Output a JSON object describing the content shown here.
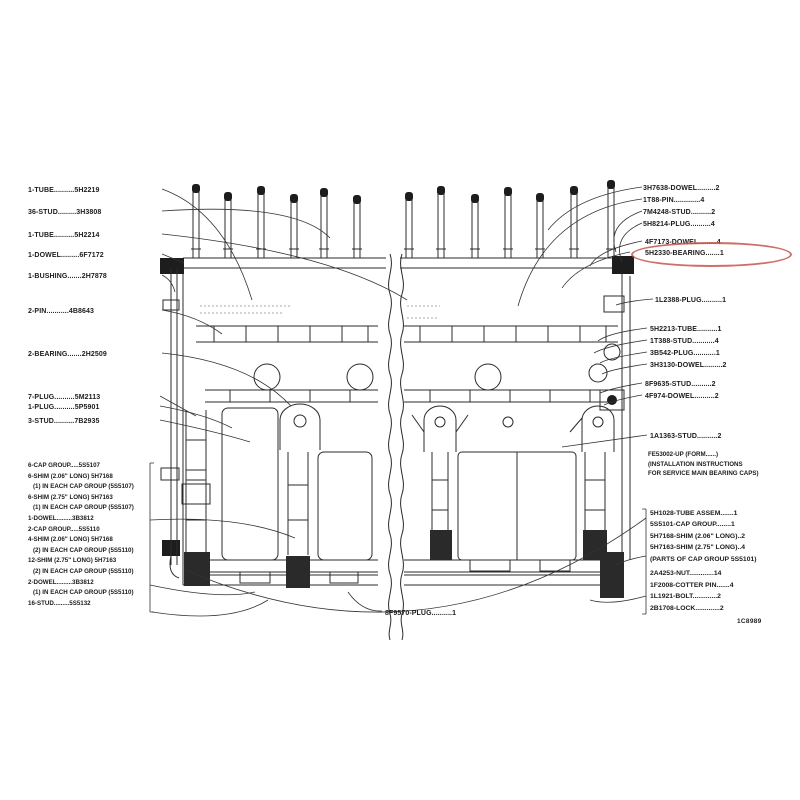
{
  "figure": {
    "number": "1C8989",
    "highlighted_part": "5H2330-BEARING",
    "highlight_color": "#c4564a"
  },
  "labels": {
    "left_column": [
      "1-TUBE..........5H2219",
      "36-STUD.........3H3808",
      "1-TUBE..........5H2214",
      "1-DOWEL.........6F7172",
      "1-BUSHING.......2H7878",
      "2-PIN...........4B8643",
      "2-BEARING.......2H2509",
      "7-PLUG..........5M2113",
      "1-PLUG..........5P5901",
      "3-STUD..........7B2935"
    ],
    "left_cap_block": [
      "6-CAP GROUP.....5S5107",
      "6-SHIM (2.06\" LONG) 5H7168",
      "(1) IN EACH CAP GROUP (5S5107)",
      "6-SHIM (2.75\" LONG) 5H7163",
      "(1) IN EACH CAP GROUP (5S5107)",
      "1-DOWEL.........3B3812",
      "2-CAP GROUP.....5S5110",
      "4-SHIM (2.06\" LONG) 5H7168",
      "(2) IN EACH CAP GROUP (5S5110)",
      "12-SHIM (2.75\" LONG) 5H7163",
      "(2) IN EACH CAP GROUP (5S5110)",
      "2-DOWEL.........3B3812",
      "(1) IN EACH CAP GROUP (5S5110)",
      "16-STUD.........5S5132"
    ],
    "right_top": [
      "3H7638-DOWEL.........2",
      "1T88-PIN.............4",
      "7M4248-STUD..........2",
      "5H8214-PLUG..........4"
    ],
    "right_bearing": [
      "4F7173-DOWEL.........4",
      "5H2330-BEARING.......1"
    ],
    "right_plug": "1L2388-PLUG..........1",
    "right_mid": [
      "5H2213-TUBE..........1",
      "1T388-STUD...........4",
      "3B542-PLUG...........1",
      "3H3130-DOWEL.........2"
    ],
    "right_studs": [
      "8F9635-STUD..........2",
      "4F974-DOWEL..........2"
    ],
    "right_stud2": "1A1363-STUD..........2",
    "right_note": [
      "FE53002-UP (FORM......)",
      "(INSTALLATION INSTRUCTIONS",
      "FOR SERVICE MAIN BEARING CAPS)"
    ],
    "right_bottom_a": [
      "5H1028-TUBE ASSEM.......1",
      "5S5101-CAP GROUP........1",
      "5H7168-SHIM (2.06\" LONG)..2",
      "5H7163-SHIM (2.75\" LONG)..4",
      "(PARTS OF CAP GROUP 5S5101)"
    ],
    "right_bottom_b": [
      "2A4253-NUT.............14",
      "1F2008-COTTER PIN.......4",
      "1L1921-BOLT.............2",
      "2B1708-LOCK.............2"
    ],
    "bottom_center": "8F9570-PLUG..........1"
  }
}
